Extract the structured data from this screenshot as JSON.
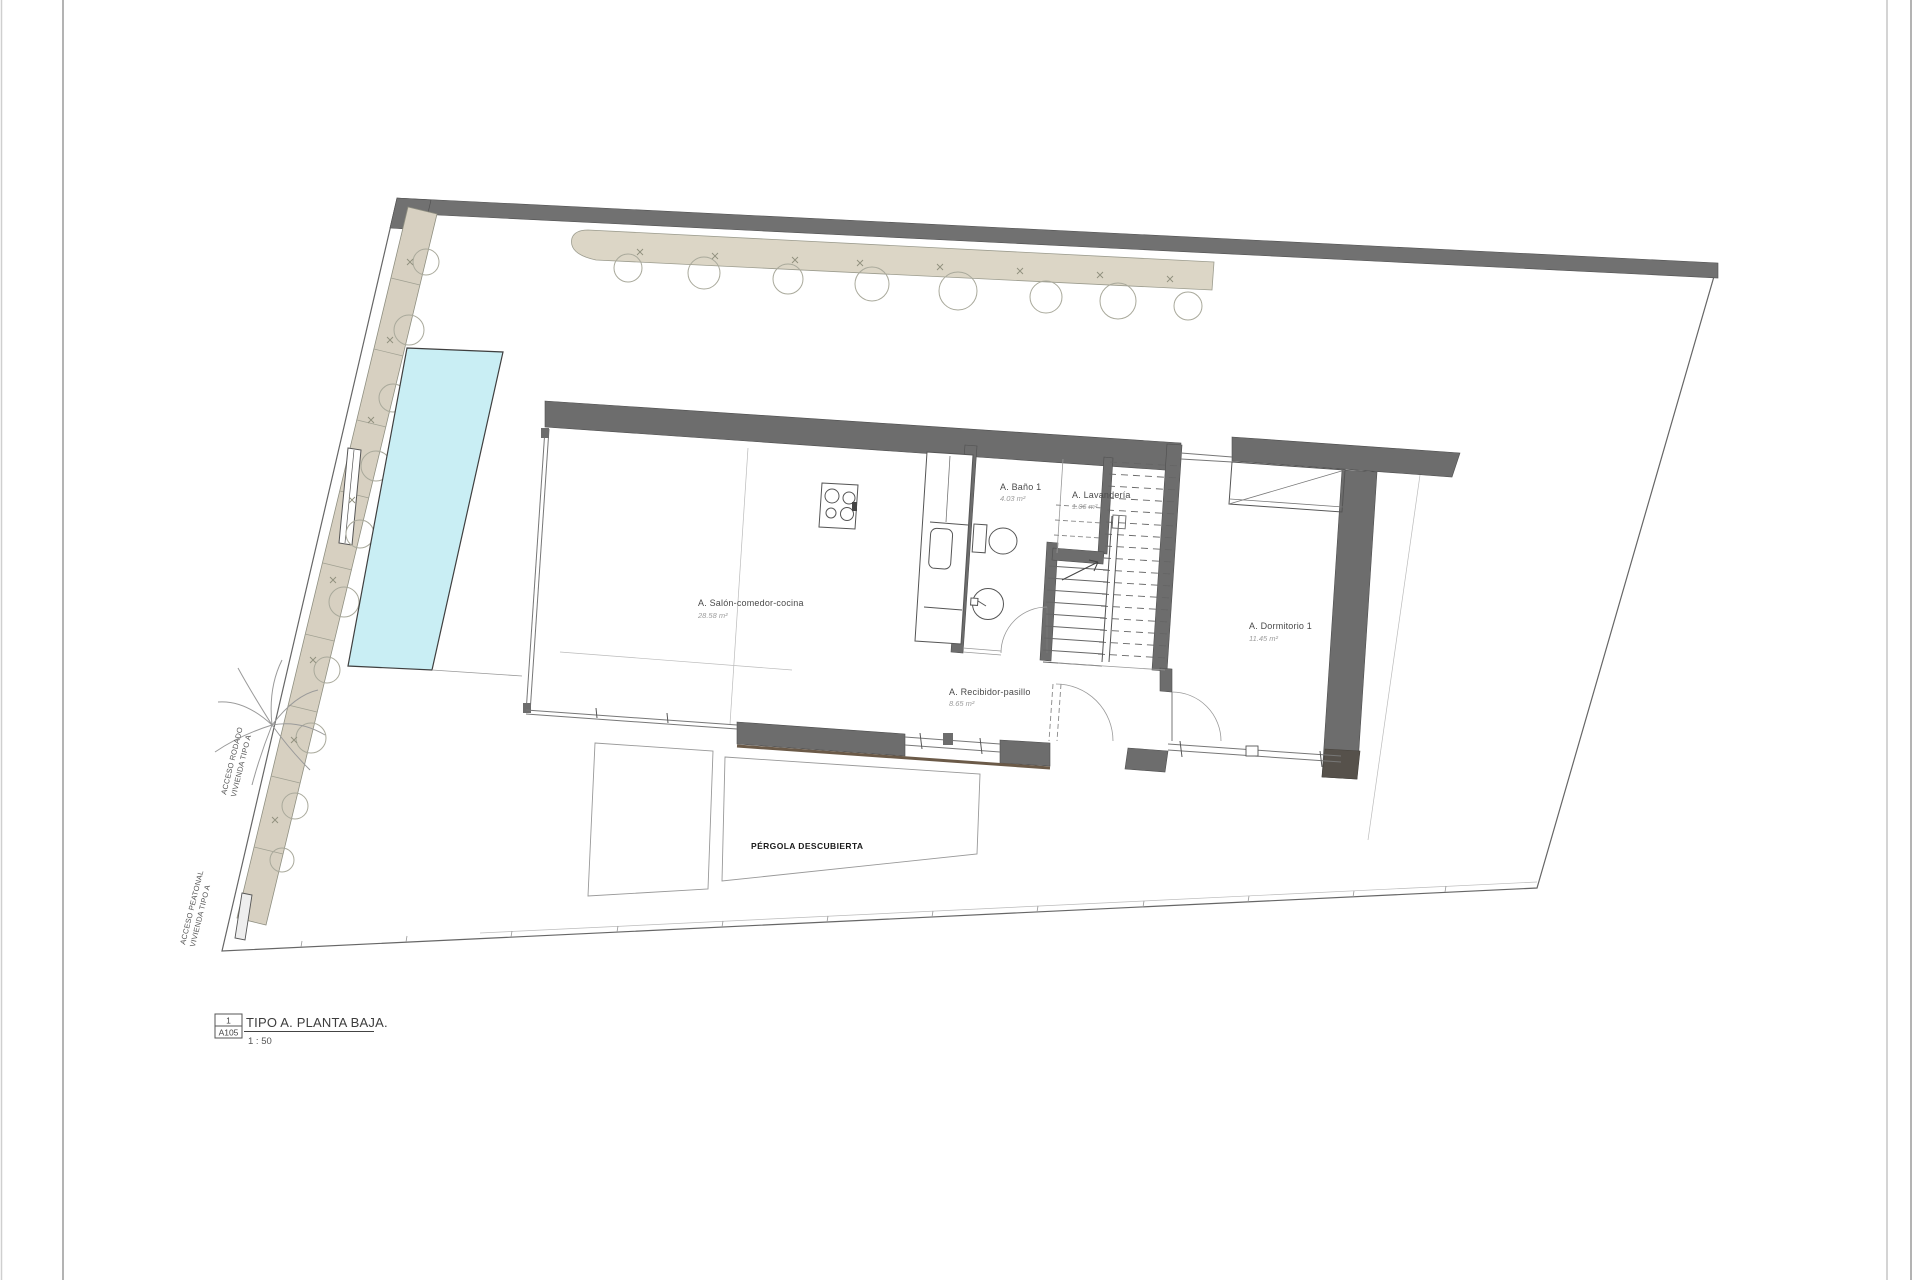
{
  "plan": {
    "rooms": {
      "salon": {
        "label": "A. Salón-comedor-cocina",
        "area": "28.58 m²"
      },
      "bano": {
        "label": "A. Baño 1",
        "area": "4.03 m²"
      },
      "lavanderia": {
        "label": "A. Lavandería",
        "area": "1.06 m²"
      },
      "dormitorio": {
        "label": "A. Dormitorio 1",
        "area": "11.45 m²"
      },
      "recibidor": {
        "label": "A. Recibidor-pasillo",
        "area": "8.65 m²"
      }
    },
    "site_labels": {
      "pergola": "PÉRGOLA DESCUBIERTA",
      "acceso_rodado_line1": "ACCESO RODADO",
      "acceso_rodado_line2": "VIVIENDA TIPO A",
      "acceso_peatonal_line1": "ACCESO PEATONAL",
      "acceso_peatonal_line2": "VIVIENDA TIPO A"
    }
  },
  "title_block": {
    "detail_number": "1",
    "sheet_number": "A105",
    "title": "TIPO A. PLANTA BAJA.",
    "scale": "1 : 50"
  },
  "colors": {
    "wall": "#6d6d6d",
    "wall_dark": "#56514b",
    "path_fill": "#d7d0c1",
    "hedge_fill": "#dcd6c6",
    "pool_fill": "#c9eef4",
    "boundary_line": "#666666"
  }
}
